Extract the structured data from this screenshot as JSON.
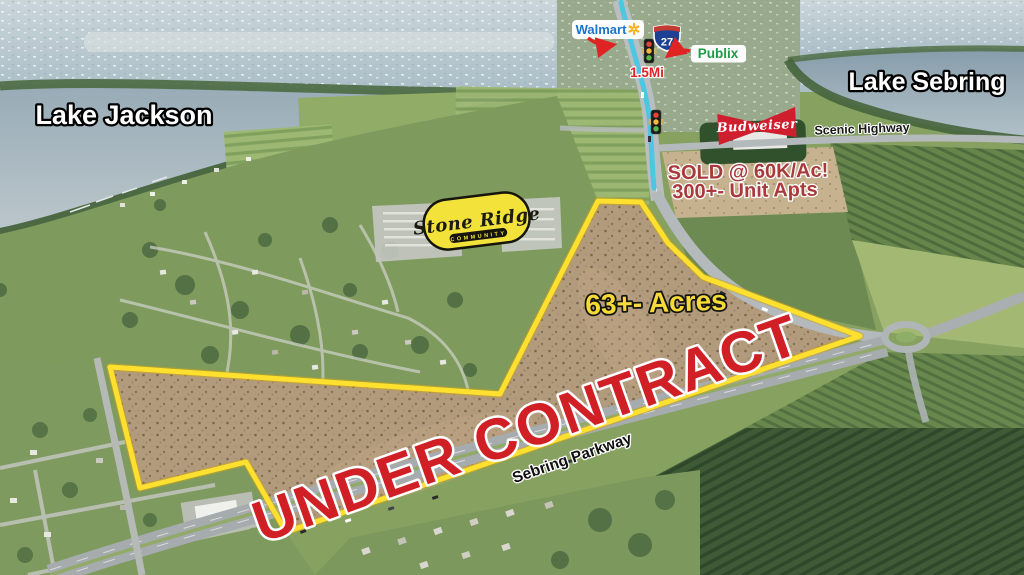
{
  "annotations": {
    "lake_left": "Lake Jackson",
    "lake_right": "Lake Sebring",
    "scenic_highway": "Scenic Highway",
    "sebring_parkway": "Sebring Parkway",
    "headline": "UNDER CONTRACT",
    "acreage": "63+- Acres",
    "sold_line1": "SOLD @ 60K/Ac!",
    "sold_line2": "300+- Unit Apts",
    "distance_marker": "1.5Mi",
    "route_shield": "27"
  },
  "businesses": {
    "walmart": "Walmart",
    "publix": "Publix",
    "budweiser": "Budweiser"
  },
  "development": {
    "name": "Stone Ridge",
    "subtitle": "COMMUNITY"
  },
  "colors": {
    "boundary_yellow": "#FFE02E",
    "headline_red": "#D11F26",
    "acreage_yellow": "#F5DA38",
    "sold_red": "#A93A3C",
    "route_cyan": "#41C7E4",
    "walmart_blue": "#1A75CF",
    "publix_green": "#1F9B49",
    "budweiser_red": "#CF1F2F",
    "logo_yellow": "#F2E23A"
  }
}
